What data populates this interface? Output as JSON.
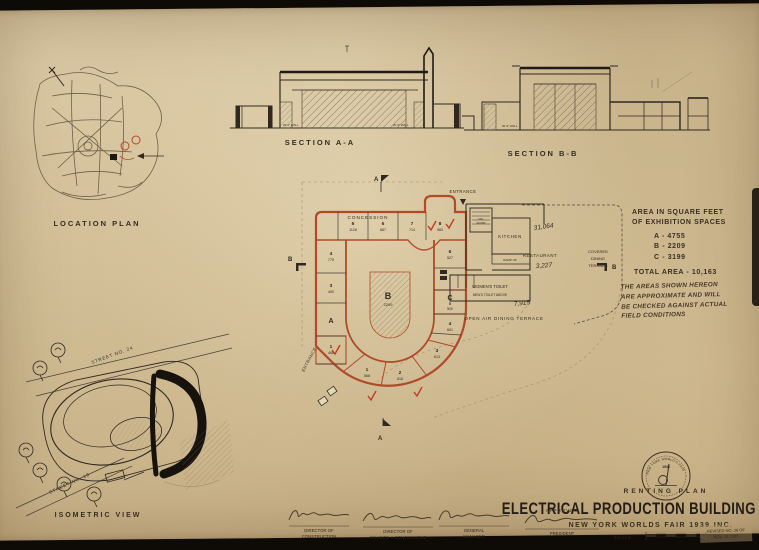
{
  "palette": {
    "paper": "#d8c5a0",
    "ink": "#2f2921",
    "red": "#b04a28",
    "pencil": "#8d7a5c",
    "background": "#0e0a06"
  },
  "titleblock": {
    "title": "ELECTRICAL PRODUCTION BUILDING",
    "organization": "NEW YORK WORLDS FAIR 1939 INC.",
    "plan_label": "RENTING PLAN",
    "scale_label": "SCALE",
    "revision_line1": "REVISED NO. 26 OF",
    "revision_line2": "NOV. 15 1937"
  },
  "seal": {
    "ring_text": "NEW YORK WORLD'S FAIR",
    "year": "1939"
  },
  "views": {
    "location_plan_label": "LOCATION PLAN",
    "section_a_label": "SECTION A-A",
    "section_b_label": "SECTION B-B",
    "isometric_label": "ISOMETRIC VIEW"
  },
  "sections": {
    "wall_label": "20'-0\" WALL"
  },
  "area_table": {
    "heading_line1": "AREA IN SQUARE FEET",
    "heading_line2": "OF EXHIBITION SPACES",
    "rows": [
      {
        "label": "A -",
        "value": "4755"
      },
      {
        "label": "B -",
        "value": "2209"
      },
      {
        "label": "C -",
        "value": "3199"
      }
    ],
    "total": "TOTAL AREA - 10,163"
  },
  "field_note": {
    "line1": "THE AREAS SHOWN HEREON",
    "line2": "ARE APPROXIMATE AND WILL",
    "line3": "BE CHECKED AGAINST ACTUAL",
    "line4": "FIELD CONDITIONS"
  },
  "plan": {
    "concession": "CONCESSION",
    "entrance_top": "ENTRANCE",
    "entrance_bottom": "ENTRANCE",
    "kitchen": "KITCHEN",
    "util_line1": "UTIL.",
    "util_line2": "ROOM",
    "ramp": "RAMP UP",
    "restaurant": "RESTAURANT",
    "covered_line1": "COVERED",
    "covered_line2": "DINING",
    "covered_line3": "TERRACE",
    "womens_toilet": "WOMEN'S TOILET",
    "mens_toilet": "MEN'S TOILET ABOVE",
    "open_air": "OPEN AIR DINING TERRACE",
    "marker_a": "A",
    "marker_b": "B",
    "zone_a": "A",
    "zone_b": "B",
    "zone_c": "C",
    "zone_b_area": "2209",
    "spaces_top": [
      {
        "id": "5",
        "area": "1128"
      },
      {
        "id": "6",
        "area": "887"
      },
      {
        "id": "7",
        "area": "714"
      },
      {
        "id": "8",
        "area": "983"
      }
    ],
    "spaces_left": [
      {
        "id": "4",
        "area": "775"
      },
      {
        "id": "3",
        "area": "400"
      },
      {
        "id": "1",
        "area": "468"
      }
    ],
    "spaces_right": [
      {
        "id": "6",
        "area": "527"
      },
      {
        "id": "5",
        "area": "500"
      },
      {
        "id": "4",
        "area": "601"
      },
      {
        "id": "3",
        "area": "613"
      }
    ],
    "spaces_bottom": [
      {
        "id": "2",
        "area": "616"
      },
      {
        "id": "1",
        "area": "568"
      }
    ],
    "pencil_note_1": "31,064",
    "pencil_note_2": "3,227",
    "pencil_note_3": "7,915"
  },
  "isometric": {
    "street_top": "STREET NO. 24",
    "street_bottom": "STREET NO. 18"
  },
  "signatures": [
    {
      "line1": "DIRECTOR OF",
      "line2": "CONSTRUCTION"
    },
    {
      "line1": "DIRECTOR OF",
      "line2": "EXHIBITS & CONCESSIONS"
    },
    {
      "line1": "GENERAL",
      "line2": "MANAGER"
    },
    {
      "approved": "APPROVED",
      "line1": "PRESIDENT"
    }
  ]
}
